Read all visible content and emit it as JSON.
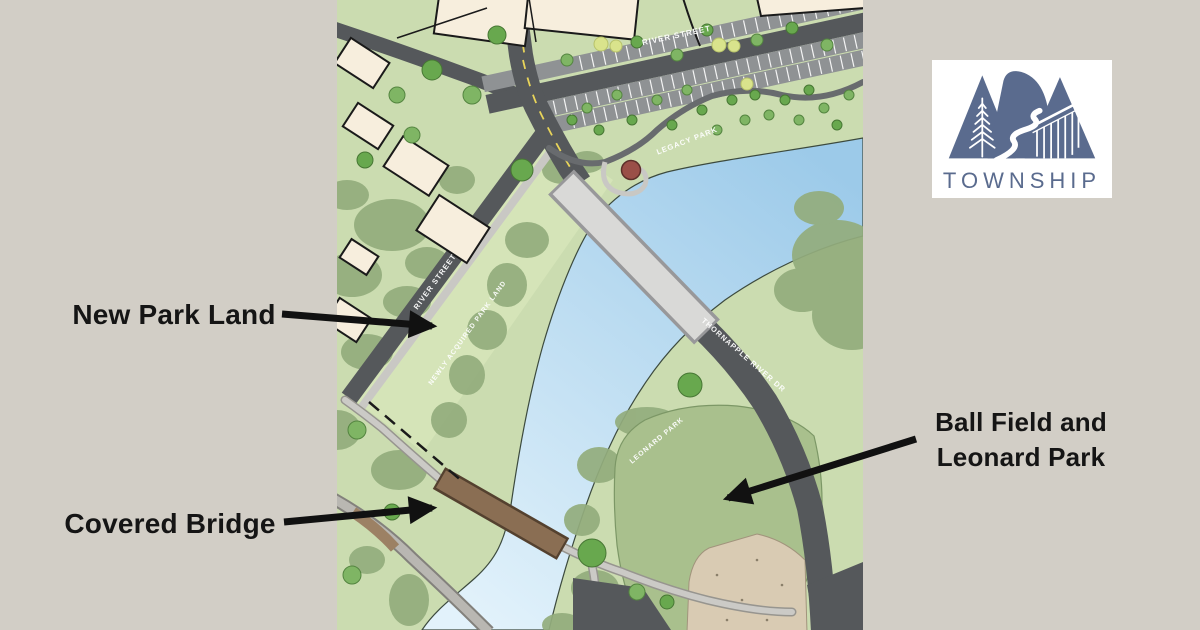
{
  "page": {
    "width": 1200,
    "height": 630,
    "background": "#d2cec6"
  },
  "annotations": {
    "arrow_color": "#111111",
    "text_color": "#151515",
    "items": [
      {
        "id": "new-park-land",
        "label": "New Park Land"
      },
      {
        "id": "covered-bridge",
        "label": "Covered Bridge"
      },
      {
        "id": "ball-field",
        "label_line1": "Ball Field and",
        "label_line2": "Leonard Park"
      }
    ]
  },
  "logo": {
    "name": "ADA",
    "wordmark": "TOWNSHIP",
    "color": "#5a6b8e",
    "background": "#ffffff"
  },
  "map": {
    "labels": {
      "river_street_top": "RIVER STREET",
      "legacy_park": "LEGACY PARK",
      "river_street_sw": "RIVER STREET",
      "newly_acquired": "NEWLY ACQUIRED PARK LAND",
      "thornapple_river_dr": "THORNAPPLE RIVER DR",
      "leonard_park": "LEONARD PARK"
    },
    "colors": {
      "grass": "#cbdcb0",
      "park_strip": "#d5e4b8",
      "water_deep": "#9ccae9",
      "water_light": "#e2f2fb",
      "road": "#55585b",
      "road_secondary": "#8f9294",
      "path": "#cbcac6",
      "trail": "#686b6e",
      "building": "#f7eedd",
      "bridge_deck": "#d9d9d7",
      "covered_bridge": "#8a6e53",
      "tree": "#68a84e",
      "tree_mass": "#93ad7d",
      "outfield": "#a9c08d",
      "infield": "#d9cbb3",
      "gazebo": "#9a4f48"
    }
  }
}
